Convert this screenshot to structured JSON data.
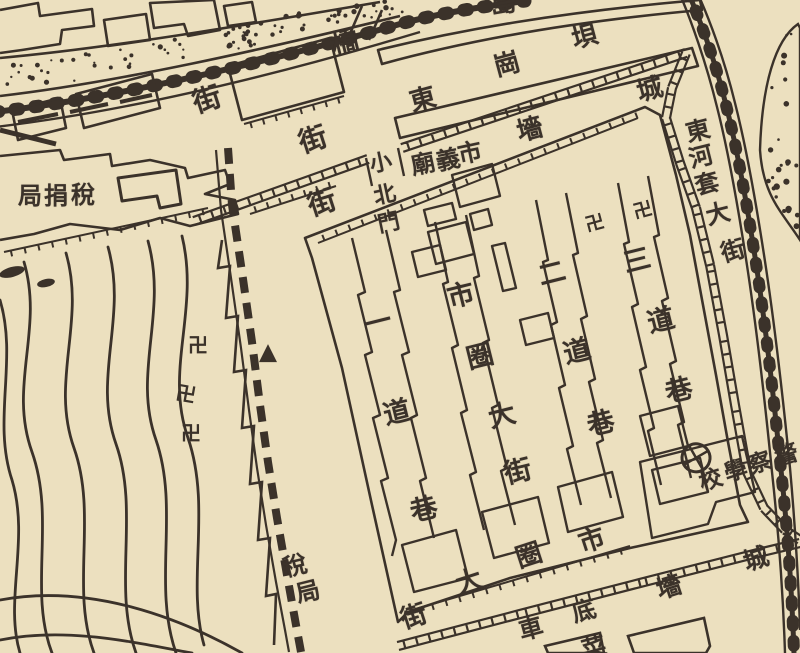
{
  "colors": {
    "paper": "#ece0bf",
    "ink": "#3b322a"
  },
  "map": {
    "description_labels": [],
    "labels": [
      {
        "name": "street-label-west",
        "text": "街",
        "size": 28,
        "chars": [
          {
            "c": "街",
            "x": 207,
            "y": 100,
            "r": -18
          }
        ]
      },
      {
        "name": "bridge-label",
        "text": "橋",
        "size": 27,
        "chars": [
          {
            "c": "橋",
            "x": 345,
            "y": 43,
            "r": -14
          }
        ]
      },
      {
        "name": "island-label-partial",
        "text": "島",
        "size": 26,
        "chars": [
          {
            "c": "島",
            "x": 503,
            "y": 4,
            "r": -10
          }
        ]
      },
      {
        "name": "donggangba-street-label",
        "text": "東崗垻",
        "size": 26,
        "chars": [
          {
            "c": "東",
            "x": 423,
            "y": 100,
            "r": -15
          },
          {
            "c": "崗",
            "x": 507,
            "y": 65,
            "r": -15
          },
          {
            "c": "垻",
            "x": 585,
            "y": 37,
            "r": -15
          }
        ]
      },
      {
        "name": "city-wall-label-north",
        "text": "城墻",
        "size": 26,
        "chars": [
          {
            "c": "城",
            "x": 650,
            "y": 90,
            "r": -15
          },
          {
            "c": "墻",
            "x": 530,
            "y": 130,
            "r": -15
          }
        ]
      },
      {
        "name": "street-label-mid",
        "text": "街",
        "size": 28,
        "chars": [
          {
            "c": "街",
            "x": 313,
            "y": 140,
            "r": -18
          }
        ]
      },
      {
        "name": "street-label-inner",
        "text": "街",
        "size": 28,
        "chars": [
          {
            "c": "街",
            "x": 322,
            "y": 203,
            "r": -18
          }
        ]
      },
      {
        "name": "small-north-gate-label",
        "text": "小北門",
        "size": 22,
        "chars": [
          {
            "c": "小",
            "x": 381,
            "y": 164,
            "r": -12
          },
          {
            "c": "北",
            "x": 385,
            "y": 196,
            "r": -12
          },
          {
            "c": "門",
            "x": 389,
            "y": 224,
            "r": -12
          }
        ]
      },
      {
        "name": "temple-label",
        "text": "義廟",
        "size": 24,
        "chars": [
          {
            "c": "義",
            "x": 448,
            "y": 160,
            "r": -12
          },
          {
            "c": "廟",
            "x": 423,
            "y": 164,
            "r": -12
          }
        ]
      },
      {
        "name": "market-label",
        "text": "市",
        "size": 24,
        "chars": [
          {
            "c": "市",
            "x": 470,
            "y": 153,
            "r": -12
          }
        ]
      },
      {
        "name": "donghetao-street-label",
        "text": "東河套大街",
        "size": 24,
        "chars": [
          {
            "c": "東",
            "x": 698,
            "y": 131,
            "r": -14
          },
          {
            "c": "河",
            "x": 701,
            "y": 157,
            "r": -14
          },
          {
            "c": "套",
            "x": 707,
            "y": 184,
            "r": -14
          },
          {
            "c": "大",
            "x": 718,
            "y": 214,
            "r": -14
          },
          {
            "c": "街",
            "x": 733,
            "y": 251,
            "r": -16
          }
        ]
      },
      {
        "name": "yidao-lane-label",
        "text": "一道巷",
        "size": 27,
        "chars": [
          {
            "c": "一",
            "x": 378,
            "y": 323,
            "r": -14
          },
          {
            "c": "道",
            "x": 397,
            "y": 413,
            "r": -14
          },
          {
            "c": "巷",
            "x": 424,
            "y": 510,
            "r": -14
          }
        ]
      },
      {
        "name": "shiquan-street-label",
        "text": "市圈大街",
        "size": 27,
        "chars": [
          {
            "c": "市",
            "x": 461,
            "y": 296,
            "r": -14
          },
          {
            "c": "圈",
            "x": 480,
            "y": 357,
            "r": -14
          },
          {
            "c": "大",
            "x": 502,
            "y": 416,
            "r": -14
          },
          {
            "c": "街",
            "x": 518,
            "y": 472,
            "r": -14
          }
        ]
      },
      {
        "name": "erdao-lane-label",
        "text": "二道巷",
        "size": 27,
        "chars": [
          {
            "c": "二",
            "x": 552,
            "y": 274,
            "r": -14
          },
          {
            "c": "道",
            "x": 577,
            "y": 352,
            "r": -14
          },
          {
            "c": "巷",
            "x": 601,
            "y": 424,
            "r": -14
          }
        ]
      },
      {
        "name": "sandao-lane-label",
        "text": "三道巷",
        "size": 27,
        "chars": [
          {
            "c": "三",
            "x": 637,
            "y": 261,
            "r": -14
          },
          {
            "c": "道",
            "x": 661,
            "y": 321,
            "r": -14
          },
          {
            "c": "巷",
            "x": 679,
            "y": 391,
            "r": -14
          }
        ]
      },
      {
        "name": "shiquan-street-label-south",
        "text": "市圈大街",
        "size": 26,
        "chars": [
          {
            "c": "市",
            "x": 592,
            "y": 541,
            "r": -18
          },
          {
            "c": "圈",
            "x": 529,
            "y": 556,
            "r": -18
          },
          {
            "c": "大",
            "x": 469,
            "y": 582,
            "r": -18
          },
          {
            "c": "街",
            "x": 414,
            "y": 617,
            "r": -18
          }
        ]
      },
      {
        "name": "city-wall-label-south",
        "text": "城墻",
        "size": 25,
        "chars": [
          {
            "c": "城",
            "x": 756,
            "y": 559,
            "r": -18
          },
          {
            "c": "墻",
            "x": 669,
            "y": 587,
            "r": -18
          }
        ]
      },
      {
        "name": "chedi-label",
        "text": "車底",
        "size": 24,
        "chars": [
          {
            "c": "底",
            "x": 584,
            "y": 611,
            "r": -15
          },
          {
            "c": "車",
            "x": 531,
            "y": 629,
            "r": -15
          }
        ]
      },
      {
        "name": "partial-label-bottom",
        "text": "菜",
        "size": 24,
        "chars": [
          {
            "c": "菜",
            "x": 594,
            "y": 648,
            "r": -15
          }
        ]
      },
      {
        "name": "tax-bureau-label",
        "text": "稅捐局",
        "size": 24,
        "chars": [
          {
            "c": "局",
            "x": 30,
            "y": 196,
            "r": 0
          },
          {
            "c": "捐",
            "x": 56,
            "y": 196,
            "r": 0
          },
          {
            "c": "稅",
            "x": 83,
            "y": 195,
            "r": 0
          }
        ]
      },
      {
        "name": "tax-office-label",
        "text": "稅局",
        "size": 24,
        "chars": [
          {
            "c": "稅",
            "x": 295,
            "y": 566,
            "r": -14
          },
          {
            "c": "局",
            "x": 308,
            "y": 592,
            "r": -14
          }
        ]
      },
      {
        "name": "police-school-label",
        "text": "警察學校",
        "size": 23,
        "chars": [
          {
            "c": "警",
            "x": 787,
            "y": 456,
            "r": -18
          },
          {
            "c": "察",
            "x": 760,
            "y": 464,
            "r": -18
          },
          {
            "c": "學",
            "x": 736,
            "y": 472,
            "r": -18
          },
          {
            "c": "校",
            "x": 711,
            "y": 481,
            "r": -18
          }
        ]
      }
    ],
    "symbols": [
      {
        "name": "swastika-marker",
        "type": "text",
        "glyph": "卍",
        "x": 198,
        "y": 345,
        "size": 20,
        "r": 0
      },
      {
        "name": "swastika-marker",
        "type": "text",
        "glyph": "卍",
        "x": 186,
        "y": 394,
        "size": 20,
        "r": 10
      },
      {
        "name": "swastika-marker",
        "type": "text",
        "glyph": "卍",
        "x": 191,
        "y": 433,
        "size": 20,
        "r": 0
      },
      {
        "name": "swastika-marker",
        "type": "text",
        "glyph": "卍",
        "x": 595,
        "y": 224,
        "size": 19,
        "r": -15
      },
      {
        "name": "swastika-marker",
        "type": "text",
        "glyph": "卍",
        "x": 643,
        "y": 211,
        "size": 19,
        "r": -15
      },
      {
        "name": "triangle-marker",
        "type": "triangle",
        "x": 268,
        "y": 354,
        "size": 18,
        "r": 0
      },
      {
        "name": "circle-cross-marker",
        "type": "circle-cross",
        "x": 684,
        "y": 437,
        "size": 34,
        "r": 15
      }
    ]
  }
}
